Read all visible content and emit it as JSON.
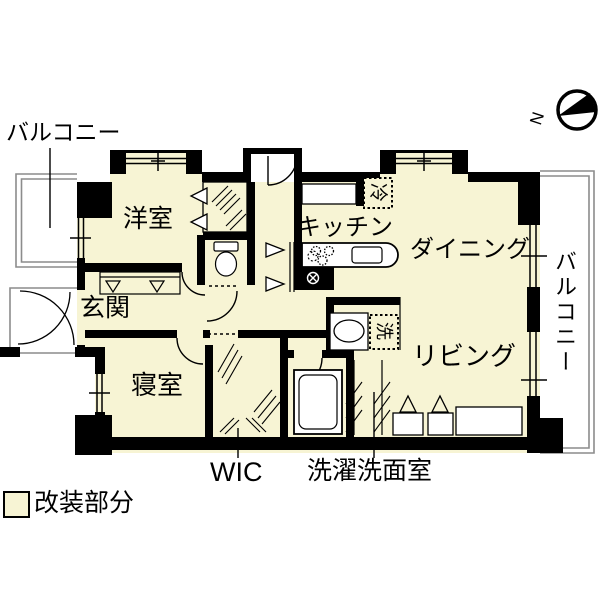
{
  "colors": {
    "renovated_fill": "#f7f4d4",
    "wall": "#000000",
    "outline_gray": "#8c8c8c",
    "background": "#ffffff"
  },
  "labels": {
    "balcony_top": "バルコニー",
    "balcony_right": "バルコニー",
    "western_room": "洋室",
    "kitchen": "キッチン",
    "dining": "ダイニング",
    "entrance": "玄関",
    "bedroom": "寝室",
    "living": "リビング",
    "wic": "WIC",
    "laundry_washroom": "洗濯洗面室",
    "refrigerator": "冷",
    "washing_machine": "洗",
    "compass_north": "N"
  },
  "legend": {
    "renovated_label": "改装部分"
  }
}
